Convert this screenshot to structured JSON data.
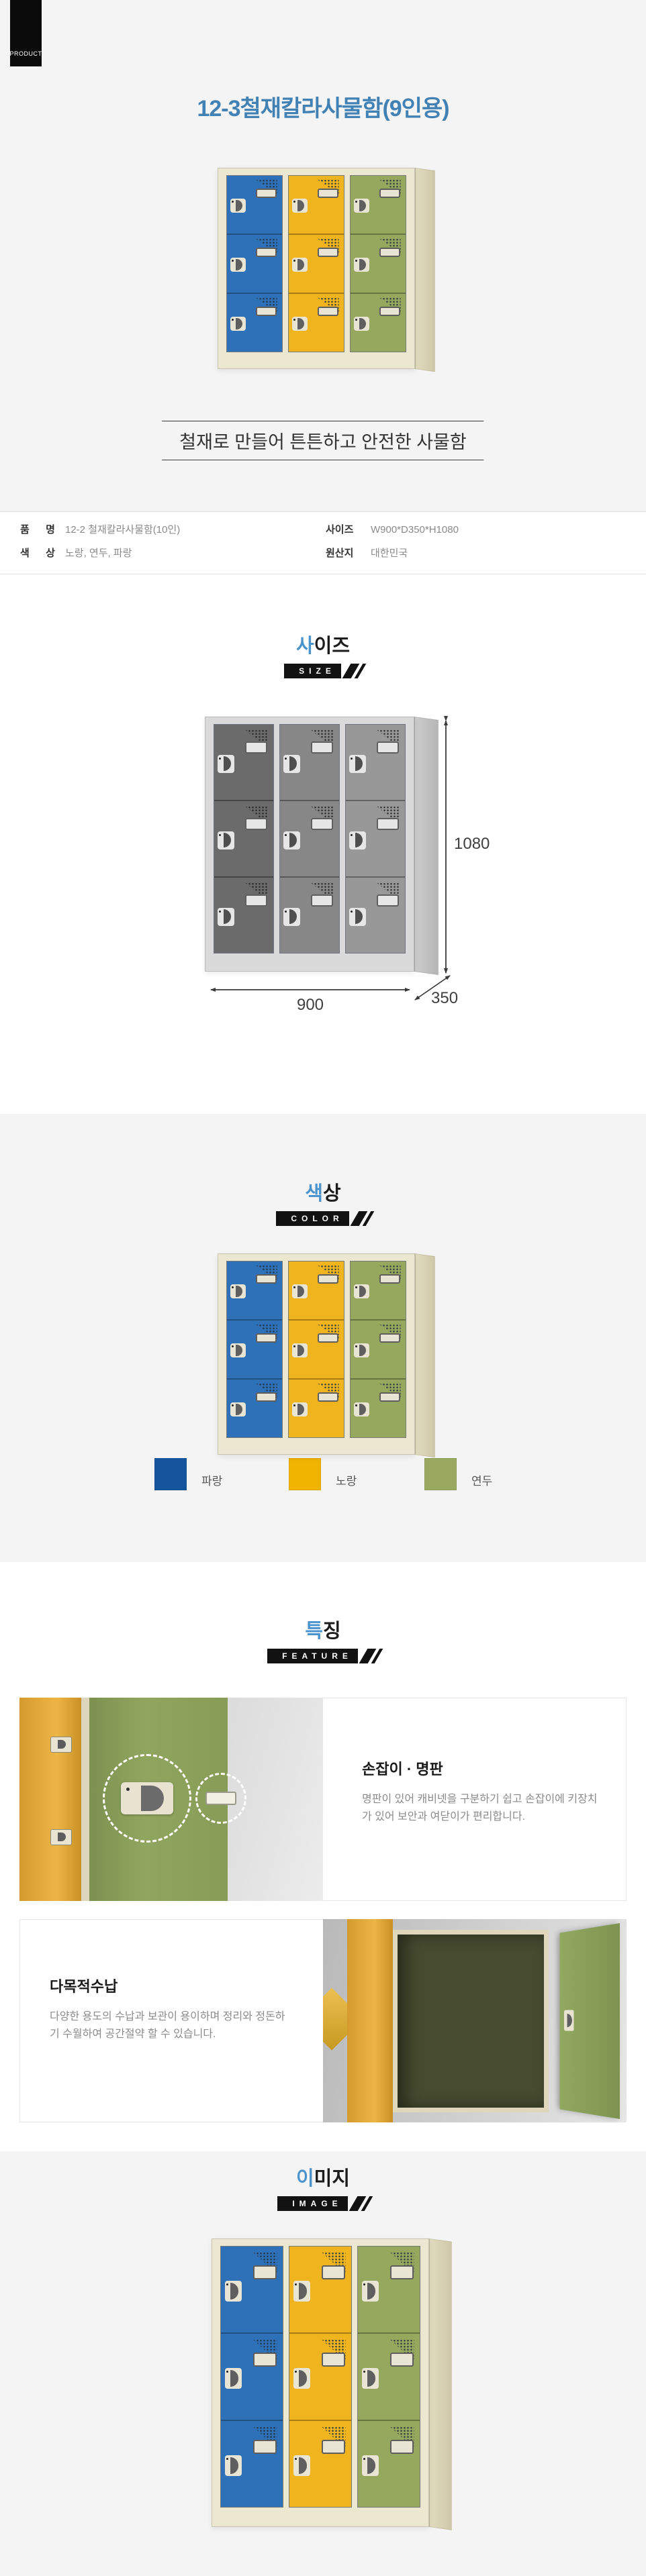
{
  "page": {
    "product_badge": "PRODUCT",
    "title": "12-3철재칼라사물함(9인용)",
    "title_color": "#4181b4",
    "tagline": "철재로 만들어 튼튼하고 안전한 사물함"
  },
  "specs": {
    "row1": {
      "label1": "품 명",
      "value1": "12-2 철재칼라사물함(10인)",
      "label2": "사이즈",
      "value2": "W900*D350*H1080"
    },
    "row2": {
      "label1": "색 상",
      "value1": "노랑, 연두, 파랑",
      "label2": "원산지",
      "value2": "대한민국"
    }
  },
  "sections": {
    "size": {
      "accent": "사",
      "rest": "이즈",
      "badge": "SIZE"
    },
    "color": {
      "accent": "색",
      "rest": "상",
      "badge": "COLOR"
    },
    "feature": {
      "accent": "특",
      "rest": "징",
      "badge": "FEATURE"
    },
    "image": {
      "accent": "이",
      "rest": "미지",
      "badge": "IMAGE"
    }
  },
  "size_diagram": {
    "width": "900",
    "depth": "350",
    "height": "1080"
  },
  "color_swatches": [
    {
      "name": "파랑",
      "hex": "#15559d"
    },
    {
      "name": "노랑",
      "hex": "#f0b300"
    },
    {
      "name": "연두",
      "hex": "#9aa960"
    }
  ],
  "features": [
    {
      "title": "손잡이 · 명판",
      "desc": "명판이 있어 캐비넷을 구분하기 쉽고 손잡이에 키장치가 있어 보안과 여닫이가 편리합니다."
    },
    {
      "title": "다목적수납",
      "desc": "다양한 용도의 수납과 보관이 용이하며 정리와 정돈하기 수월하여 공간절약 할 수 있습니다."
    }
  ],
  "locker_palettes": {
    "color": {
      "body": "#ece7d0",
      "side1": "#e2dcc0",
      "side2": "#cfc8a8",
      "doors": [
        "#2e71b8",
        "#f0b41e",
        "#96a85e"
      ],
      "plate": "#e9e5d5",
      "handle": "#5f5f5f",
      "dot": "#20303c",
      "line": "rgba(0,0,0,0.3)"
    },
    "gray": {
      "body": "#dadada",
      "side1": "#cccccc",
      "side2": "#b6b6b6",
      "doors": [
        "#6b6b6b",
        "#878787",
        "#989898"
      ],
      "plate": "#e6e6e6",
      "handle": "#4f4f4f",
      "dot": "#222222",
      "line": "rgba(0,0,0,0.35)"
    }
  }
}
